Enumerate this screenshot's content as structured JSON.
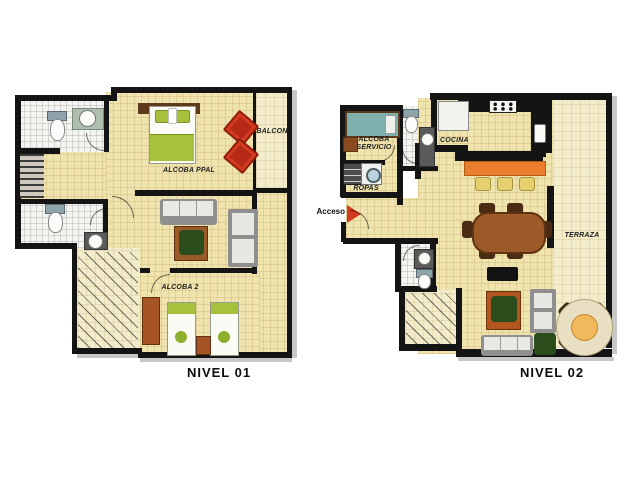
{
  "plans": [
    {
      "title": "NIVEL 01",
      "rooms": {
        "alcoba_ppal": "ALCOBA PPAL",
        "balcon": "BALCON",
        "alcoba_2": "ALCOBA 2"
      }
    },
    {
      "title": "NIVEL 02",
      "rooms": {
        "alcoba_servicio": "ALCOBA SERVICIO",
        "ropas": "ROPAS",
        "cocina": "COCINA",
        "terraza": "TERRAZA"
      },
      "entrance_label": "Acceso"
    }
  ],
  "colors": {
    "wall": "#141414",
    "floor": "#efe3ae",
    "floor_light": "#f3ecca",
    "bath_floor": "#f4f4f0",
    "accent_red": "#d43a1f",
    "accent_green": "#a6c13c",
    "accent_orange": "#e87e2e",
    "wood": "#9c5a28",
    "wood_dark": "#5e3a1c",
    "gray_furniture": "#8f8f8f",
    "teal": "#7fb0ad",
    "stool_yellow": "#e5cf6e"
  }
}
